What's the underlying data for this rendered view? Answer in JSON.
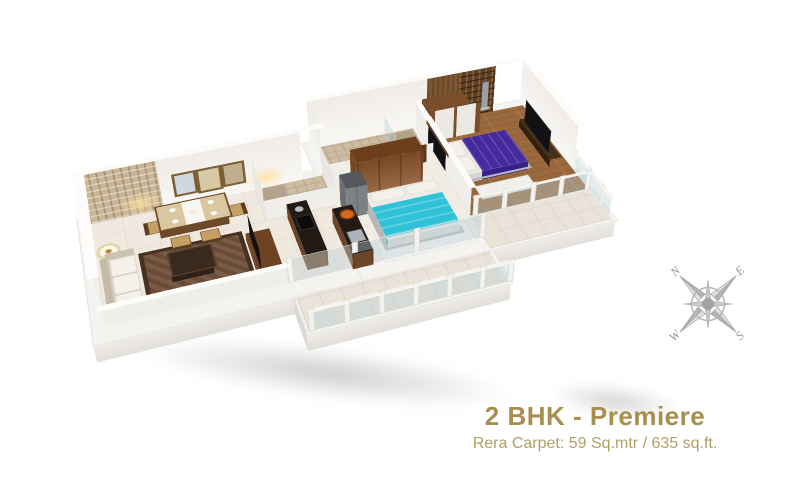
{
  "caption": {
    "title": "2 BHK - Premiere",
    "subtitle": "Rera Carpet: 59 Sq.mtr / 635 sq.ft."
  },
  "compass": {
    "north": "N",
    "east": "E",
    "south": "S",
    "west": "W"
  },
  "palette": {
    "caption_gold": "#a88f4f",
    "subtitle_gold": "#b2a066",
    "wall_white": "#f5f3f0",
    "marble_floor": "#f0e9df",
    "wood_floor": "#9a6a3e",
    "master_bed_purple": "#452a9e",
    "second_bed_cyan": "#2fc1d6",
    "kitchen_counter_black": "#221a14",
    "wardrobe_brown": "#8a5228",
    "compass_gray": "#b5b5b5"
  }
}
